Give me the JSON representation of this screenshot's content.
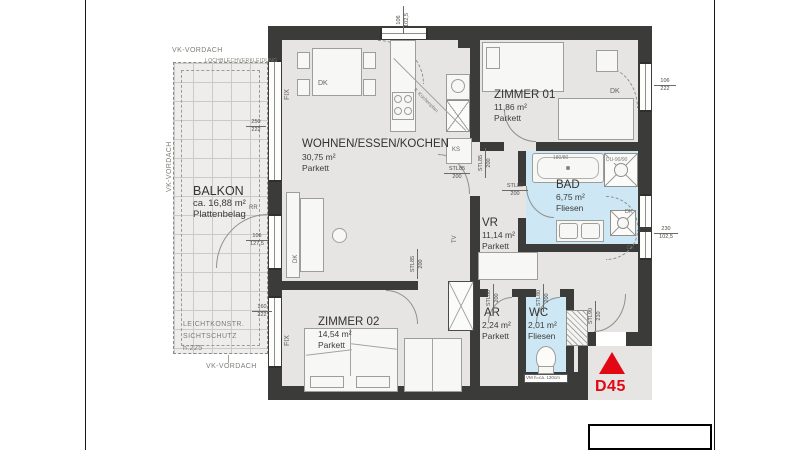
{
  "unit": {
    "label": "D45"
  },
  "rooms": {
    "wohnen": {
      "name": "WOHNEN/ESSEN/KOCHEN",
      "area": "30,75 m²",
      "floor": "Parkett"
    },
    "zimmer01": {
      "name": "ZIMMER 01",
      "area": "11,86 m²",
      "floor": "Parkett"
    },
    "bad": {
      "name": "BAD",
      "area": "6,75 m²",
      "floor": "Fliesen"
    },
    "vr": {
      "name": "VR",
      "area": "11,14 m²",
      "floor": "Parkett"
    },
    "zimmer02": {
      "name": "ZIMMER 02",
      "area": "14,54 m²",
      "floor": "Parkett"
    },
    "ar": {
      "name": "AR",
      "area": "2,24 m²",
      "floor": "Parkett"
    },
    "wc": {
      "name": "WC",
      "area": "2,01 m²",
      "floor": "Fliesen"
    },
    "balkon": {
      "name": "BALKON",
      "area": "ca. 16,88 m²",
      "floor": "Plattenbelag"
    }
  },
  "annotations": {
    "vk_vordach": "VK-VORDACH",
    "lochblech": "LOCHBLECHVERKLEIDUNG",
    "leicht1": "LEICHTKONSTR.",
    "leicht2": "SICHTSCHUTZ",
    "leicht3": "h:225",
    "fix": "FIX",
    "dk": "DK",
    "rr": "RR",
    "ks": "KS",
    "tv": "TV",
    "kueche": "lt. Küchenplan",
    "tub": "180/80",
    "shower": "DU-90/90",
    "wc_note": "VM h=ca. 120cm"
  },
  "dimensions": {
    "win_top": {
      "t": "106",
      "b": "102,5"
    },
    "win_z01": {
      "t": "106",
      "b": "222"
    },
    "win_bad": {
      "t": "230",
      "b": "102,5"
    },
    "balk1": {
      "t": "250",
      "b": "222"
    },
    "balk2": {
      "t": "106",
      "b": "127,5"
    },
    "balk3": {
      "t": "160",
      "b": "222"
    },
    "stl85": {
      "t": "STL85",
      "b": "200"
    },
    "stl80": {
      "t": "STL80",
      "b": "200"
    },
    "stl90": {
      "t": "STL90",
      "b": "210"
    }
  },
  "colors": {
    "wall": "#3b3b39",
    "floor": "#e6e5e3",
    "tile_blue": "#cde8f4",
    "accent_red": "#e30613"
  }
}
